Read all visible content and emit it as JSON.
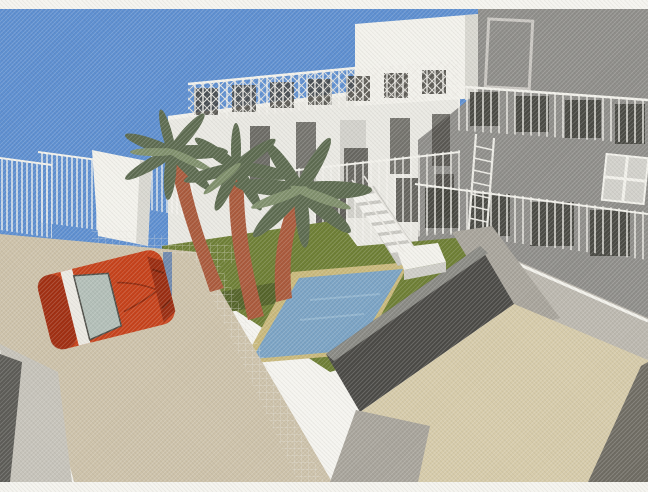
{
  "scene": {
    "type": "3d-architectural-rendering-scan",
    "description": "Scanned 3D architectural rendering of a modern villa courtyard: white and gray multi-storey buildings with roof-terrace railings, an exterior staircase and ladder, a green lawn with three palm trees, a blue swimming pool with tan coping, a dark perimeter wall, beige patio and driveway, white picket fence panels against a blue sky, and an orange-red sports car parked on the driveway.",
    "palette": {
      "paper": "#f5f4ef",
      "sky": "#5e8fd0",
      "building_white": "#eae9e3",
      "building_white_shade": "#d9d8d1",
      "facade_gray": "#8f8e8a",
      "facade_light": "#bcb8af",
      "window_dark": "#43423c",
      "window_light": "#d2d1cb",
      "railing_white": "#f3f2ec",
      "lawn": "#6e7f35",
      "lawn_dark": "#55642a",
      "pool_water": "#7ba3c4",
      "pool_coping": "#c9b97c",
      "wall_dark": "#4b4a46",
      "wall_cap": "#8a8a84",
      "courtyard": "#d6cbaa",
      "driveway": "#cdc2aa",
      "path_gray": "#a8a49b",
      "edge_dark": "#5d5c57",
      "edge_light": "#c6c3ba",
      "car_red": "#c6421b",
      "car_red_dark": "#9a2c10",
      "windshield": "#b3bfb8",
      "trunk": "#aa5a3c",
      "frond": "#5d6b50",
      "frond_light": "#80906c",
      "fence_post_blue": "#5f7fae"
    }
  }
}
